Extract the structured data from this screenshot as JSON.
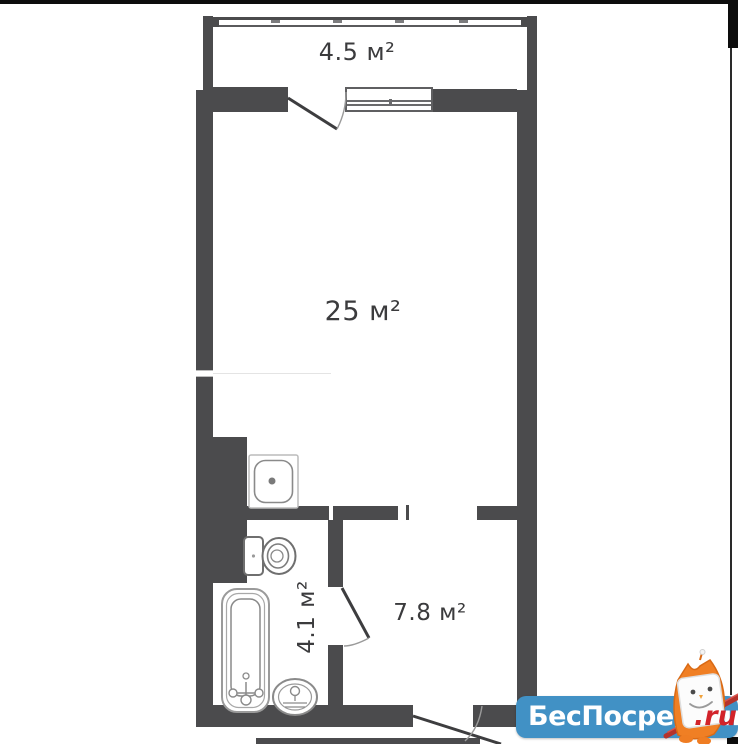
{
  "plan": {
    "wall_color": "#4b4b4d",
    "label_color": "#3b3b3d",
    "rooms": [
      {
        "id": "balcony",
        "label": "4.5 м²",
        "area": 4.5
      },
      {
        "id": "living-room",
        "label": "25 м²",
        "area": 25
      },
      {
        "id": "bathroom",
        "label": "4.1 м²",
        "area": 4.1
      },
      {
        "id": "hallway",
        "label": "7.8 м²",
        "area": 7.8
      }
    ],
    "fixtures": [
      "kitchen-sink",
      "toilet",
      "bathtub",
      "washbasin"
    ],
    "doors": [
      "balcony-door",
      "bathroom-door",
      "entrance-door"
    ],
    "windows": [
      "balcony-glazing",
      "room-window"
    ]
  },
  "watermark": {
    "site_name": "БесПосредника",
    "domain_suffix": ".ru",
    "badge_color": "#4191c5",
    "site_name_color": "#ffffff",
    "suffix_color": "#d2232a",
    "mascot": "owl"
  }
}
